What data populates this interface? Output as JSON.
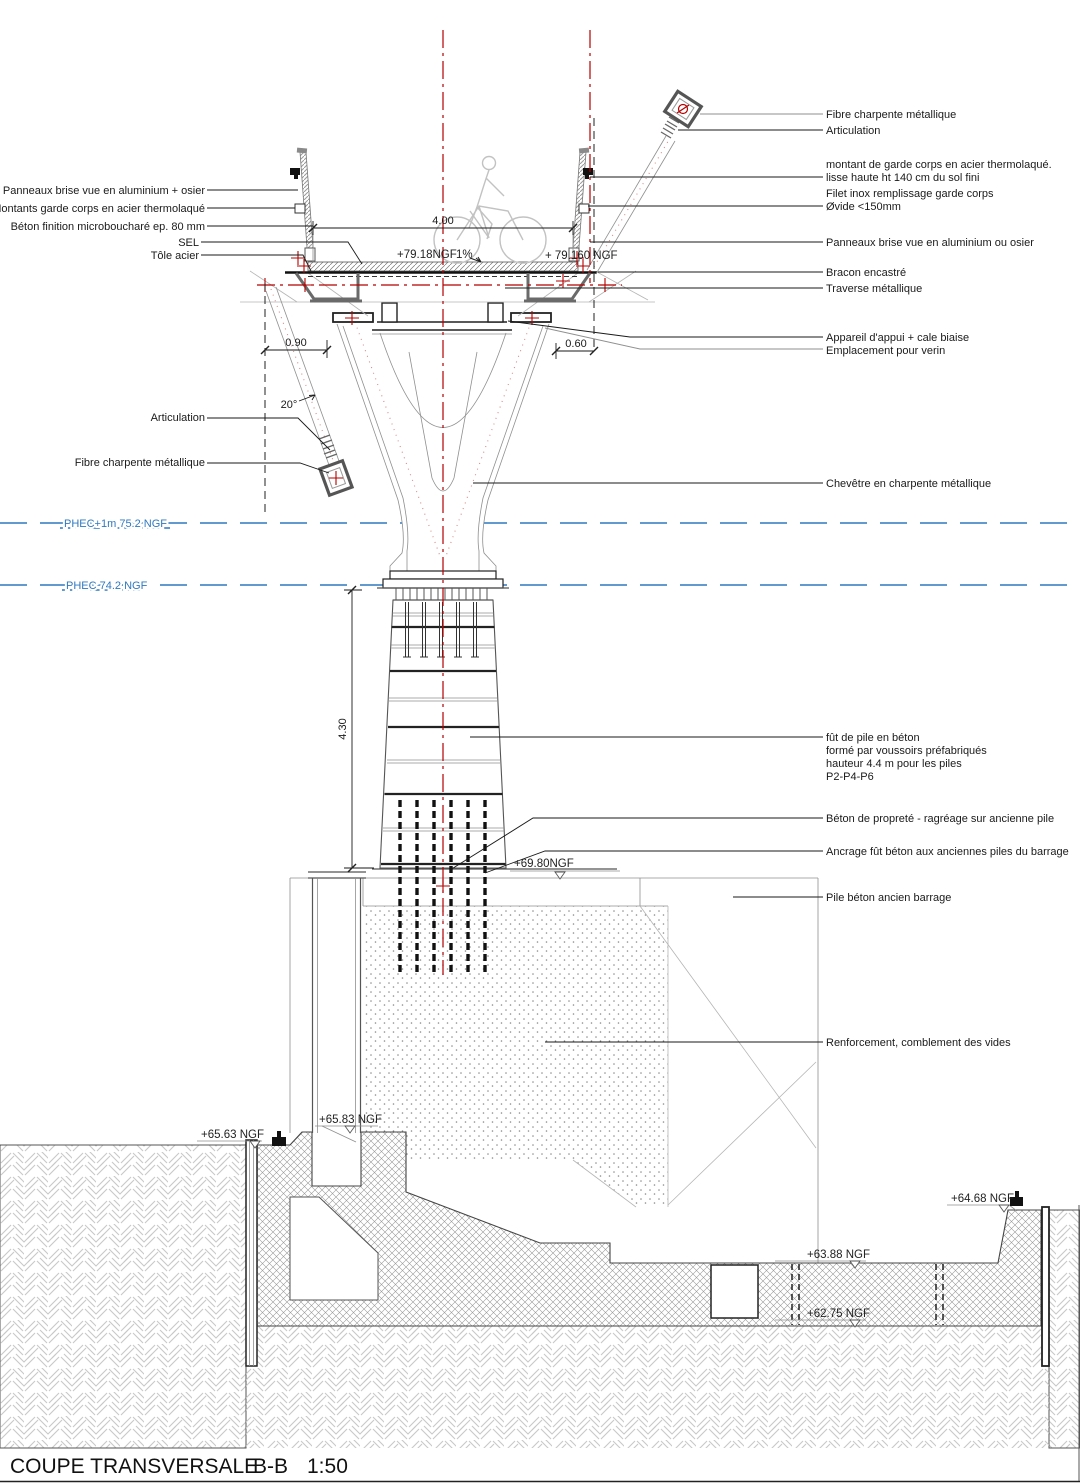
{
  "title": {
    "name": "COUPE TRANSVERSALE",
    "section": "B-B",
    "scale": "1:50"
  },
  "colors": {
    "centerline_red": "#b40000",
    "axis_pink": "#d98989",
    "phec_blue": "#2e79c0",
    "ink": "#1a1a1a"
  },
  "phec": {
    "upper_label": "PHEC+1m 75.2 NGF",
    "lower_label": "PHEC 74.2 NGF"
  },
  "dimensions": {
    "deck_width": "4.00",
    "left_offset": "0.90",
    "right_offset": "0.60",
    "bracon_angle": "20°",
    "pier_height": "4.30"
  },
  "levels": {
    "deck_left": "+79.18NGF",
    "deck_slope": "1%",
    "deck_right": "+ 79.160 NGF",
    "pier_base": "+69.80NGF",
    "caisson_bottom": "+65.83 NGF",
    "ground_left": "+65.63 NGF",
    "bank_right": "+64.68 NGF",
    "bed_upper": "+63.88 NGF",
    "bed_lower": "+62.75 NGF"
  },
  "labels_left": [
    "Panneaux brise vue en aluminium  + osier",
    "Montants garde corps  en acier thermolaqué",
    "Béton finition microboucharé ep. 80 mm",
    "SEL",
    "Tôle acier",
    "Articulation",
    "Fibre charpente métallique"
  ],
  "labels_right": [
    "Fibre charpente métallique",
    "Articulation",
    "montant de garde corps en acier thermolaqué.",
    "lisse haute ht 140 cm du sol fini",
    "Filet inox  remplissage garde corps",
    "Øvide <150mm",
    "Panneaux brise vue en aluminium ou osier",
    "Bracon encastré",
    "Traverse métallique",
    "Appareil d'appui + cale biaise",
    "Emplacement pour verin",
    "Chevêtre en charpente métallique",
    "fût de pile en béton",
    "formé par voussoirs préfabriqués",
    "hauteur 4.4 m   pour les piles",
    "P2-P4-P6",
    "Béton de propreté - ragréage sur ancienne pile",
    "Ancrage fût béton aux anciennes piles du barrage",
    "Pile béton  ancien barrage",
    "Renforcement, comblement des vides"
  ]
}
